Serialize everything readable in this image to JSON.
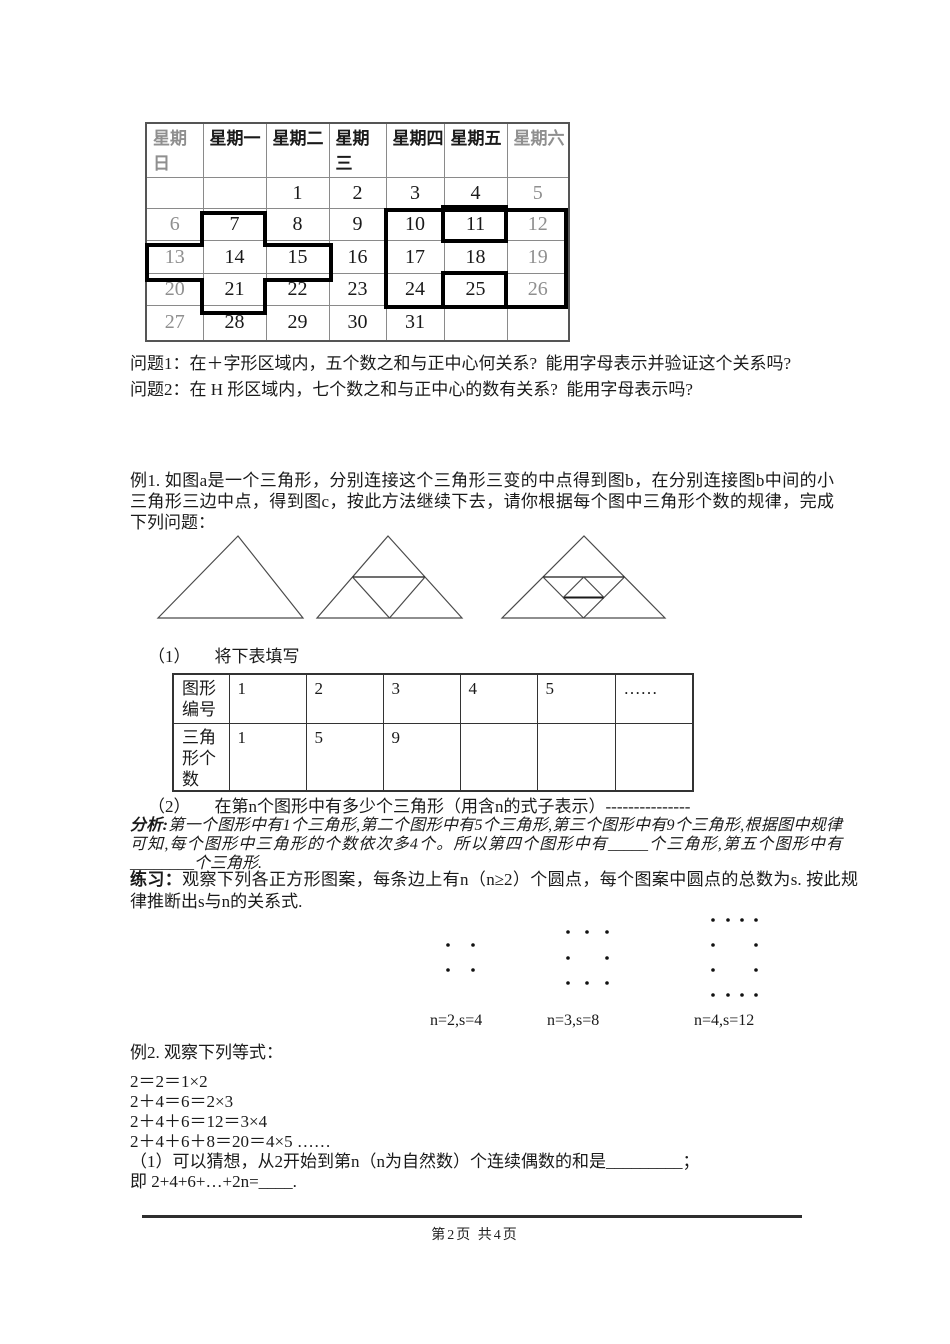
{
  "calendar": {
    "headers": [
      "星期日",
      "星期一",
      "星期二",
      "星期三",
      "星期四",
      "星期五",
      "星期六"
    ],
    "rows": [
      [
        "",
        "",
        "1",
        "2",
        "3",
        "4",
        "5"
      ],
      [
        "6",
        "7",
        "8",
        "9",
        "10",
        "11",
        "12"
      ],
      [
        "13",
        "14",
        "15",
        "16",
        "17",
        "18",
        "19"
      ],
      [
        "20",
        "21",
        "22",
        "23",
        "24",
        "25",
        "26"
      ],
      [
        "27",
        "28",
        "29",
        "30",
        "31",
        "",
        ""
      ]
    ],
    "outline_color": "#000000",
    "muted_color": "#8f8f8f"
  },
  "questions": {
    "q1": "问题1：在＋字形区域内，五个数之和与正中心何关系?  能用字母表示并验证这个关系吗?",
    "q2": "问题2：在 H 形区域内，七个数之和与正中心的数有关系?  能用字母表示吗?"
  },
  "example1": {
    "text": "例1. 如图a是一个三角形，分别连接这个三角形三变的中点得到图b，在分别连接图b中间的小三角形三边中点，得到图c，按此方法继续下去，请你根据每个图中三角形个数的规律，完成下列问题：",
    "sub1_label": "（1）",
    "sub1_text": "将下表填写",
    "sub2_label": "（2）",
    "sub2_text": "在第n个图形中有多少个三角形（用含n的式子表示）---------------"
  },
  "fill_table": {
    "row1": [
      "图形编号",
      "1",
      "2",
      "3",
      "4",
      "5",
      "……"
    ],
    "row2": [
      "三角形个数",
      "1",
      "5",
      "9",
      "",
      "",
      ""
    ]
  },
  "analysis": {
    "label": "分析:",
    "text": "第一个图形中有1个三角形,第二个图形中有5个三角形,第三个图形中有9个三角形,根据图中规律可知,每个图形中三角形的个数依次多4个。所以第四个图形中有_____个三角形,第五个图形中有________个三角形."
  },
  "practice": {
    "label": "练习：",
    "text": "观察下列各正方形图案，每条边上有n（n≥2）个圆点，每个图案中圆点的总数为s. 按此规律推断出s与n的关系式."
  },
  "dot_figures": {
    "labels": [
      "n=2,s=4",
      "n=3,s=8",
      "n=4,s=12"
    ]
  },
  "example2": {
    "title": "例2. 观察下列等式：",
    "lines": [
      "2＝2＝1×2",
      "2＋4＝6＝2×3",
      "2＋4＋6＝12＝3×4",
      "2＋4＋6＋8＝20＝4×5 ……",
      "（1）可以猜想，从2开始到第n（n为自然数）个连续偶数的和是_________；",
      "即 2+4+6+…+2n=____."
    ]
  },
  "footer": {
    "page_label": "第2页 共4页"
  }
}
